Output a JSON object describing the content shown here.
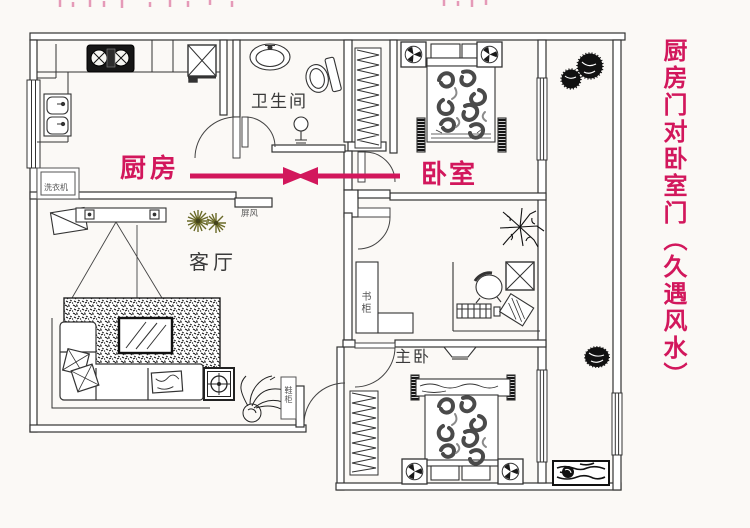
{
  "caption": "厨房门对卧室门（久遇风水）",
  "room_labels": {
    "kitchen": "厨房",
    "bedroom": "卧室",
    "bathroom": "卫生间",
    "living_room": "客厅",
    "master_bedroom": "主卧"
  },
  "furniture_labels": {
    "bookcase": "书柜",
    "washing_machine": "洗衣机",
    "screen_cabinet": "屏风",
    "shoe_cabinet": "鞋柜"
  },
  "annotation": {
    "arrow_left_room": "厨房",
    "arrow_right_room": "卧室",
    "meaning": "厨房门对卧室门"
  },
  "colors": {
    "accent": "#d2175c",
    "line": "#3a3a3a",
    "plant_accent": "#6a6a28",
    "background": "#fbf9f6"
  }
}
